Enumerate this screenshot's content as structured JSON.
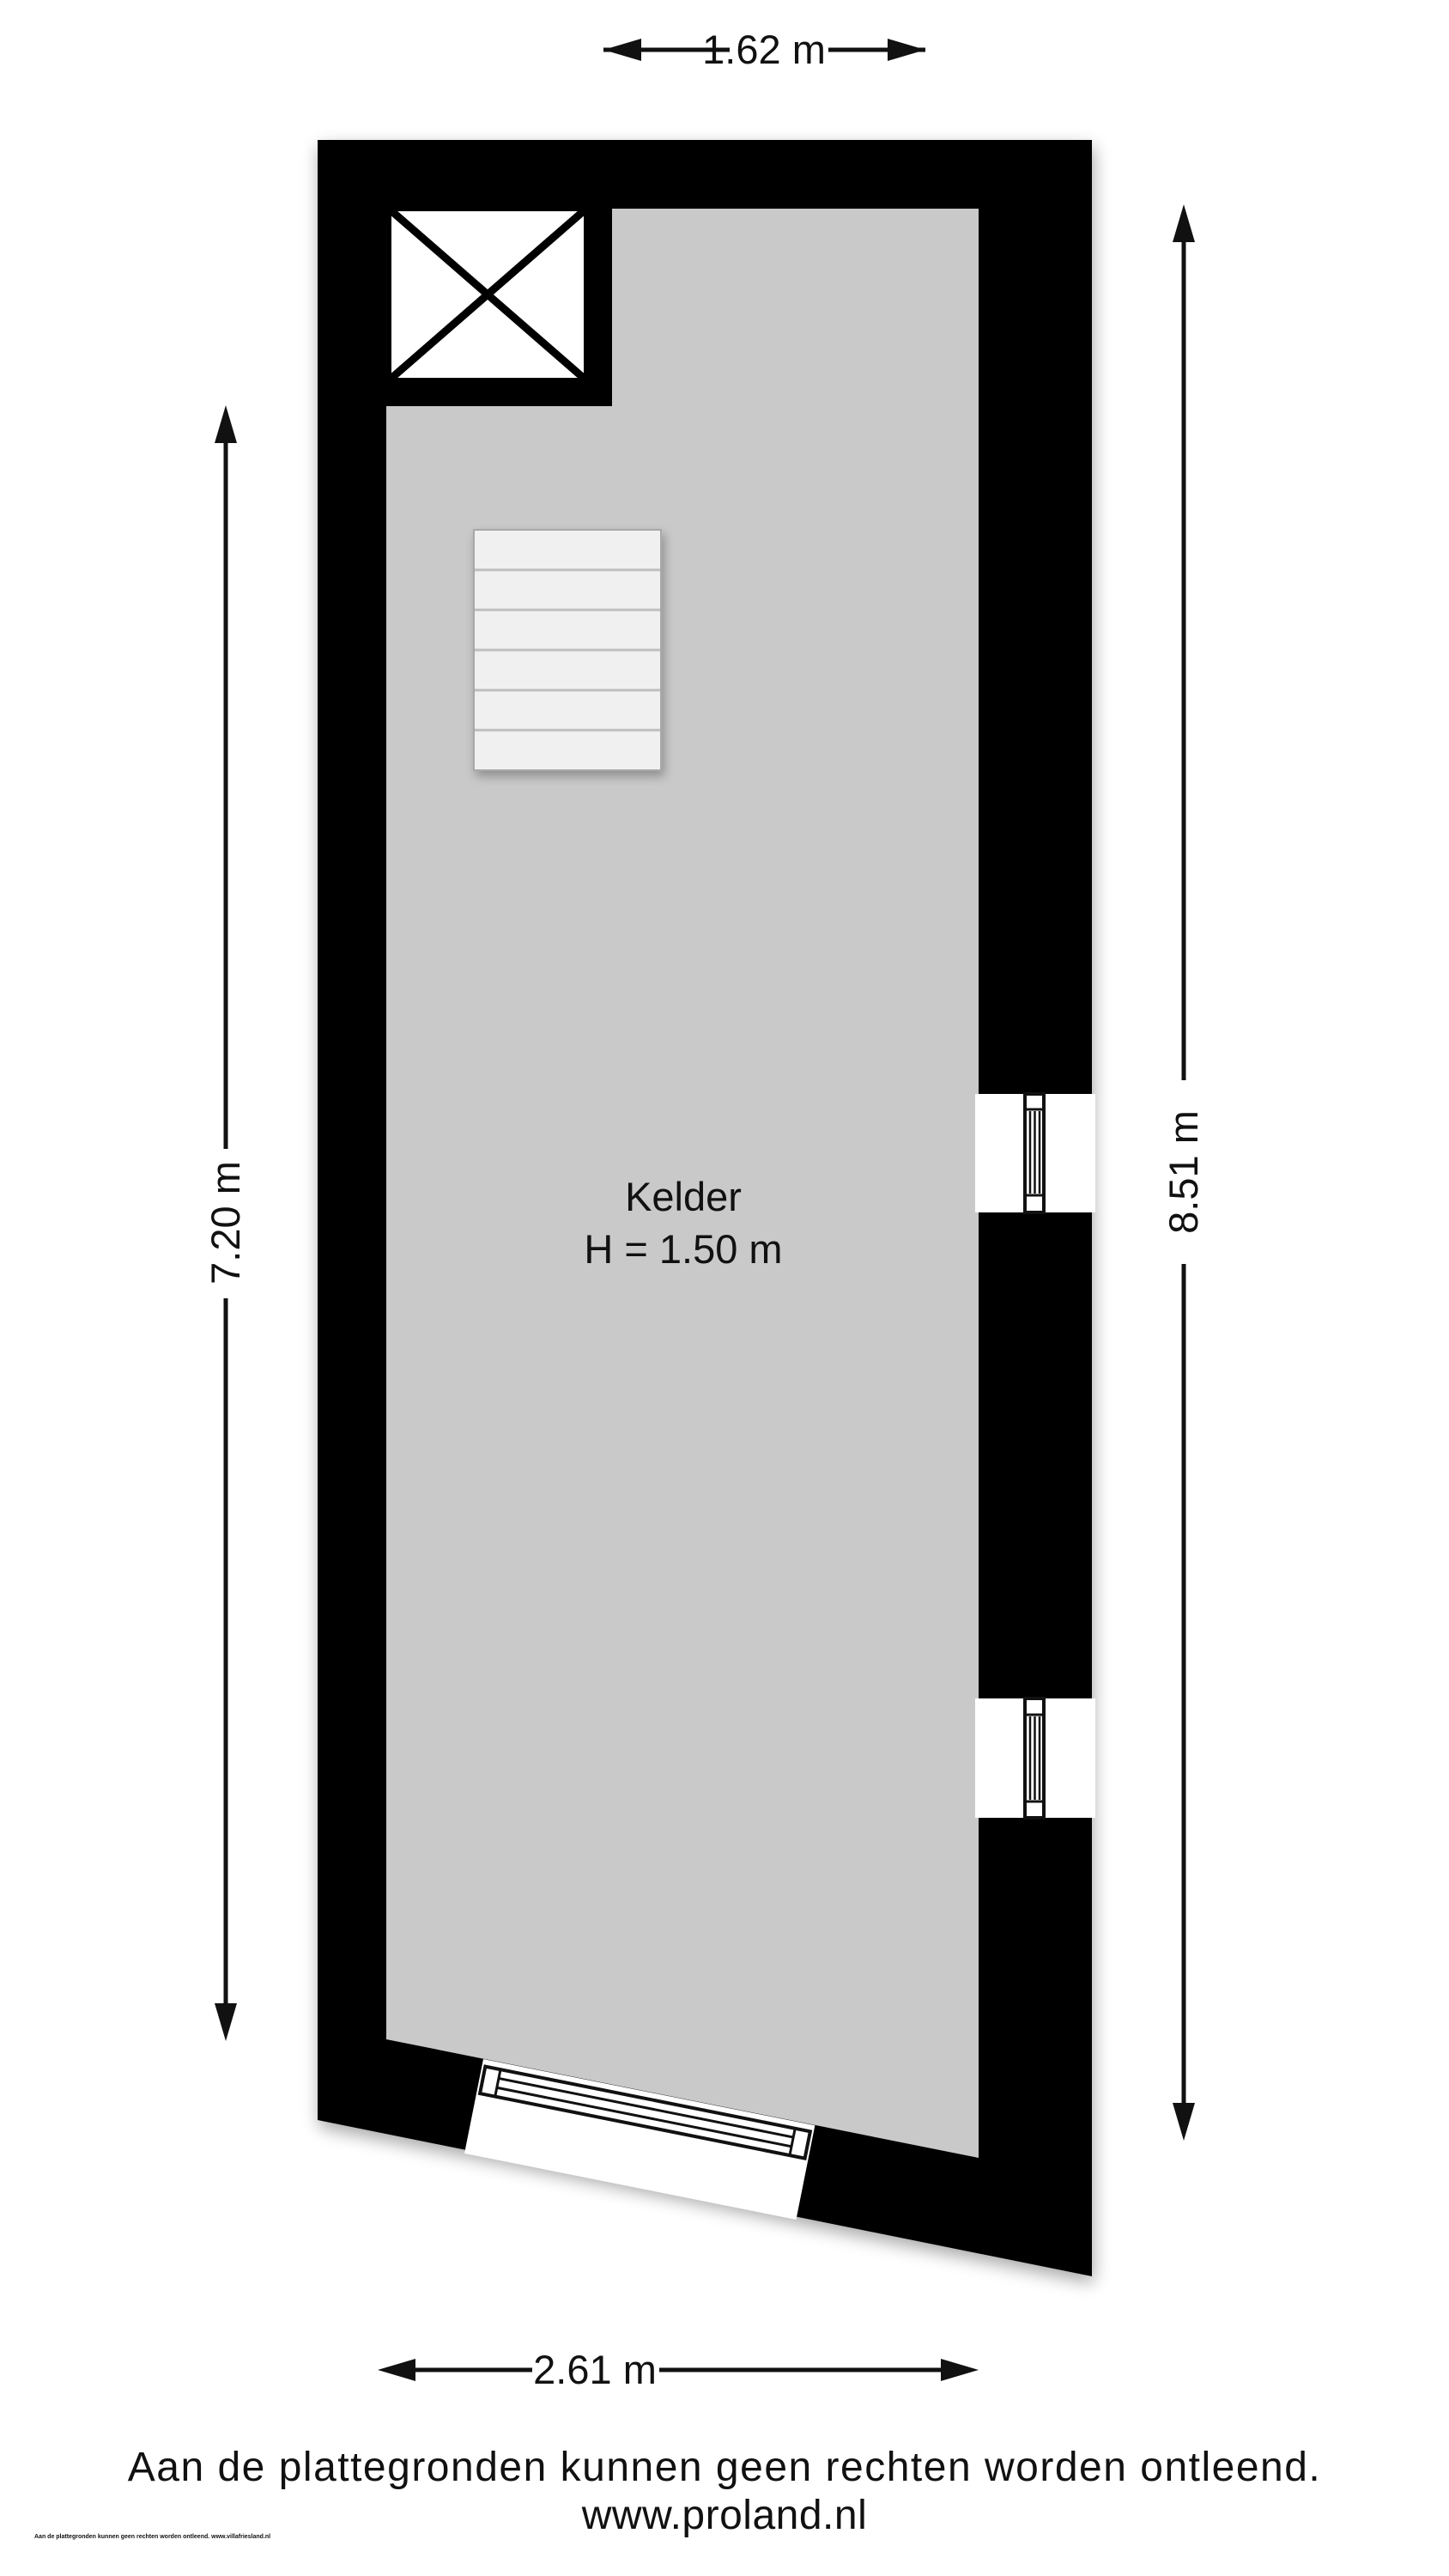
{
  "plan": {
    "room": {
      "name": "Kelder",
      "height_label": "H = 1.50 m"
    },
    "dimensions": {
      "top_width": "1.62 m",
      "left_height": "7.20 m",
      "right_height": "8.51 m",
      "bottom_width": "2.61 m"
    },
    "colors": {
      "wall": "#000000",
      "floor": "#c9c9c9",
      "stair": "#f0f0f0",
      "line": "#111111"
    }
  },
  "footer": {
    "disclaimer": "Aan de plattegronden kunnen geen rechten worden ontleend.",
    "website": "www.proland.nl",
    "fine_print": "Aan de plattegronden kunnen geen rechten worden ontleend. www.villafriesland.nl"
  }
}
